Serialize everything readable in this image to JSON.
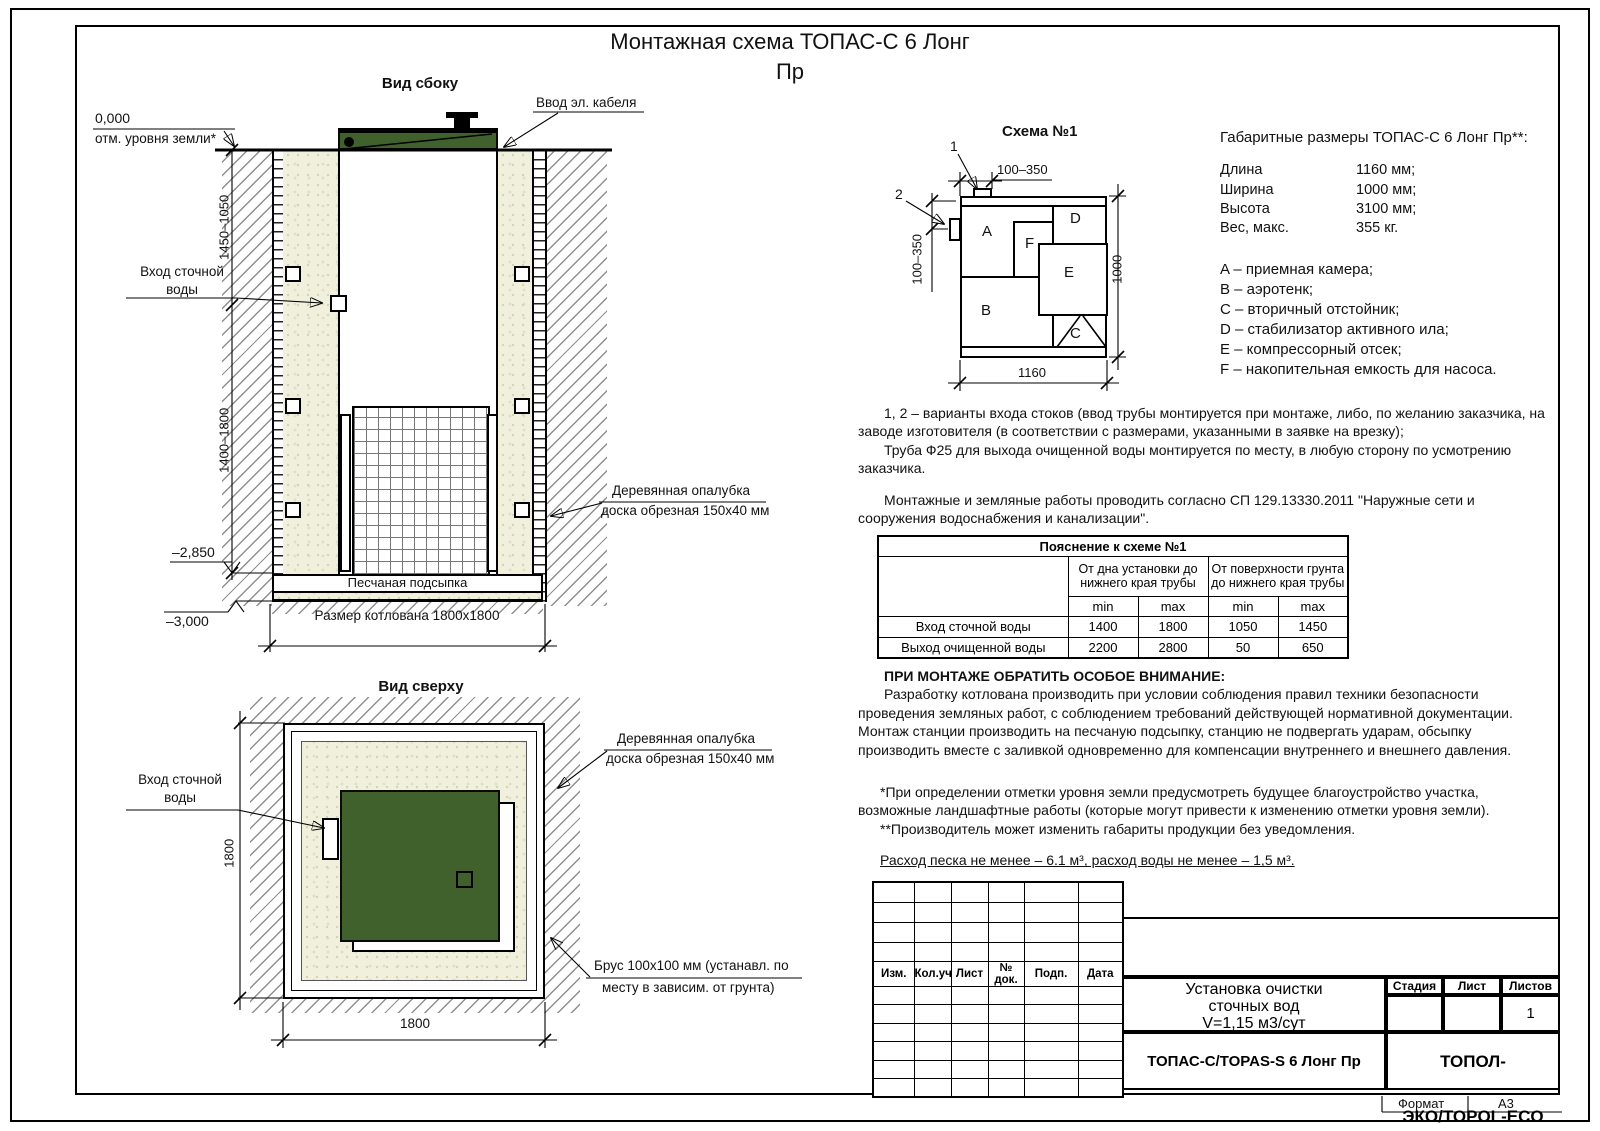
{
  "doc": {
    "title_line1": "Монтажная схема ТОПАС-С 6 Лонг",
    "title_line2": "Пр",
    "format_label": "Формат",
    "format_value": "А3"
  },
  "side_view": {
    "caption": "Вид сбоку",
    "cable_label": "Ввод эл. кабеля",
    "zero_mark": "0,000",
    "ground_note": "отм. уровня земли*",
    "dim_upper": "1450–1050",
    "dim_lower": "1400–1800",
    "inlet_line1": "Вход сточной",
    "inlet_line2": "воды",
    "elev_mid": "–2,850",
    "elev_bottom": "–3,000",
    "sand_label": "Песчаная подсыпка",
    "pit_dim": "Размер котлована 1800х1800",
    "formwork_line1": "Деревянная опалубка",
    "formwork_line2": "доска обрезная 150х40 мм"
  },
  "top_view": {
    "caption": "Вид сверху",
    "inlet_line1": "Вход сточной",
    "inlet_line2": "воды",
    "formwork_line1": "Деревянная опалубка",
    "formwork_line2": "доска обрезная 150х40 мм",
    "brus_line1": "Брус 100х100 мм (устанавл. по",
    "brus_line2": "месту в зависим. от грунта)",
    "dim_left": "1800",
    "dim_bottom": "1800"
  },
  "schema": {
    "caption": "Схема №1",
    "callout_1": "1",
    "callout_2": "2",
    "dim_top": "100–350",
    "dim_left": "100–350",
    "dim_bottom": "1160",
    "dim_right": "1000",
    "compartments": {
      "a": "A",
      "b": "B",
      "c": "C",
      "d": "D",
      "e": "E",
      "f": "F"
    }
  },
  "specs": {
    "heading": "Габаритные размеры ТОПАС-С 6 Лонг Пр**:",
    "rows": [
      {
        "label": "Длина",
        "value": "1160 мм;"
      },
      {
        "label": "Ширина",
        "value": "1000 мм;"
      },
      {
        "label": "Высота",
        "value": "3100 мм;"
      },
      {
        "label": "Вес, макс.",
        "value": "355 кг."
      }
    ],
    "legend": [
      "A – приемная камера;",
      "B – аэротенк;",
      "C – вторичный отстойник;",
      "D – стабилизатор активного ила;",
      "E – компрессорный отсек;",
      "F – накопительная емкость для насоса."
    ]
  },
  "notes": {
    "p1": "1, 2 – варианты входа  стоков (ввод трубы монтируется при монтаже, либо, по желанию заказчика, на заводе изготовителя (в соответствии с размерами, указанными в заявке на врезку);",
    "p2": "Труба Ф25 для выхода очищенной воды монтируется по месту, в любую сторону по усмотрению заказчика.",
    "p3": "Монтажные и земляные работы проводить согласно СП 129.13330.2011 \"Наружные сети и сооружения водоснабжения и канализации\"."
  },
  "table": {
    "title": "Пояснение к схеме №1",
    "group1": "От дна установки до нижнего края трубы",
    "group2": "От поверхности грунта до нижнего края трубы",
    "min": "min",
    "max": "max",
    "rows": [
      {
        "name": "Вход сточной воды",
        "g1min": "1400",
        "g1max": "1800",
        "g2min": "1050",
        "g2max": "1450"
      },
      {
        "name": "Выход очищенной воды",
        "g1min": "2200",
        "g1max": "2800",
        "g2min": "50",
        "g2max": "650"
      }
    ]
  },
  "attention": {
    "heading": "ПРИ МОНТАЖЕ ОБРАТИТЬ ОСОБОЕ ВНИМАНИЕ:",
    "body": "Разработку котлована производить при условии соблюдения правил техники безопасности проведения земляных работ, с соблюдением требований действующей нормативной документации. Монтаж станции производить на песчаную подсыпку, станцию не подвергать ударам, обсыпку производить вместе с заливкой одновременно для компенсации внутреннего и внешнего давления."
  },
  "footnotes": {
    "f1": "*При определении отметки уровня земли предусмотреть будущее благоустройство участка, возможные ландшафтные работы (которые могут привести к изменению отметки уровня земли).",
    "f2": "**Производитель может изменить габариты продукции без уведомления.",
    "consumption": "Расход песка не менее – 6.1 м³, расход воды не менее – 1,5 м³."
  },
  "title_block": {
    "col_headers": [
      "Изм.",
      "Кол.уч.",
      "Лист",
      "№ док.",
      "Подп.",
      "Дата"
    ],
    "name_line1": "Установка очистки",
    "name_line2": "сточных вод",
    "name_line3": "V=1,15 м3/сут",
    "stage_label": "Стадия",
    "sheet_label": "Лист",
    "sheets_label": "Листов",
    "sheets_value": "1",
    "model": "ТОПАС-С/TOPAS-S 6 Лонг Пр",
    "company": "ТОПОЛ-ЭКО/TOPOL-ECO"
  },
  "colors": {
    "unit_green": "#40602c",
    "sand_fill": "#f1f0dd"
  }
}
